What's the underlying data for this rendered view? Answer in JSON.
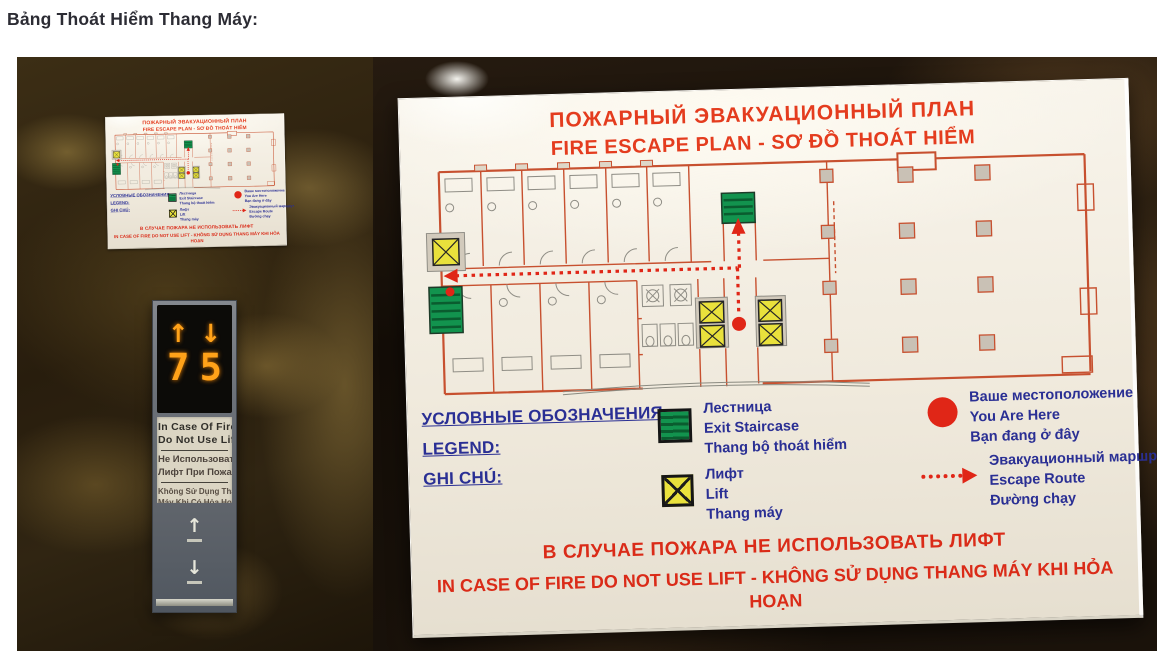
{
  "page": {
    "title": "Bảng Thoát Hiểm Thang Máy:"
  },
  "sign": {
    "title_ru": "ПОЖАРНЫЙ ЭВАКУАЦИОННЫЙ ПЛАН",
    "title_envi": "FIRE ESCAPE PLAN - SƠ ĐỒ THOÁT HIỂM",
    "legend_headings": {
      "ru": "УСЛОВНЫЕ ОБОЗНАЧЕНИЯ:",
      "en": "LEGEND:",
      "vi": "GHI CHÚ:"
    },
    "legend": {
      "staircase": {
        "ru": "Лестница",
        "en": "Exit Staircase",
        "vi": "Thang bộ thoát hiểm"
      },
      "lift": {
        "ru": "Лифт",
        "en": "Lift",
        "vi": "Thang máy"
      },
      "you_are_here": {
        "ru": "Ваше местоположение",
        "en": "You Are Here",
        "vi": "Bạn đang ở đây"
      },
      "escape_route": {
        "ru": "Эвакуационный маршрут",
        "en": "Escape Route",
        "vi": "Đường chạy"
      }
    },
    "warning_ru": "В СЛУЧАЕ ПОЖАРА НЕ ИСПОЛЬЗОВАТЬ ЛИФТ",
    "warning_envi": "IN CASE OF FIRE DO NOT USE LIFT - KHÔNG SỬ DỤNG THANG MÁY KHI HỎA HOẠN"
  },
  "elevator": {
    "up_arrow": "↑",
    "down_arrow": "↓",
    "up_floor": "7",
    "down_floor": "5",
    "notice": {
      "en1": "In Case Of Fire",
      "en2": "Do Not Use Lift",
      "ru1": "Не Использовать",
      "ru2": "Лифт При Пожаре",
      "vi1": "Không Sử Dụng Thang",
      "vi2": "Máy Khi Có Hỏa Hoạn"
    }
  },
  "colors": {
    "sign_red": "#e43c1e",
    "warning_red": "#da2b18",
    "legend_blue": "#2a2f94",
    "stair_green": "#12934e",
    "lift_yellow": "#e9e13c",
    "route_red": "#e02617",
    "plan_wall_red": "#c7502f",
    "led_orange": "#ffa219"
  }
}
